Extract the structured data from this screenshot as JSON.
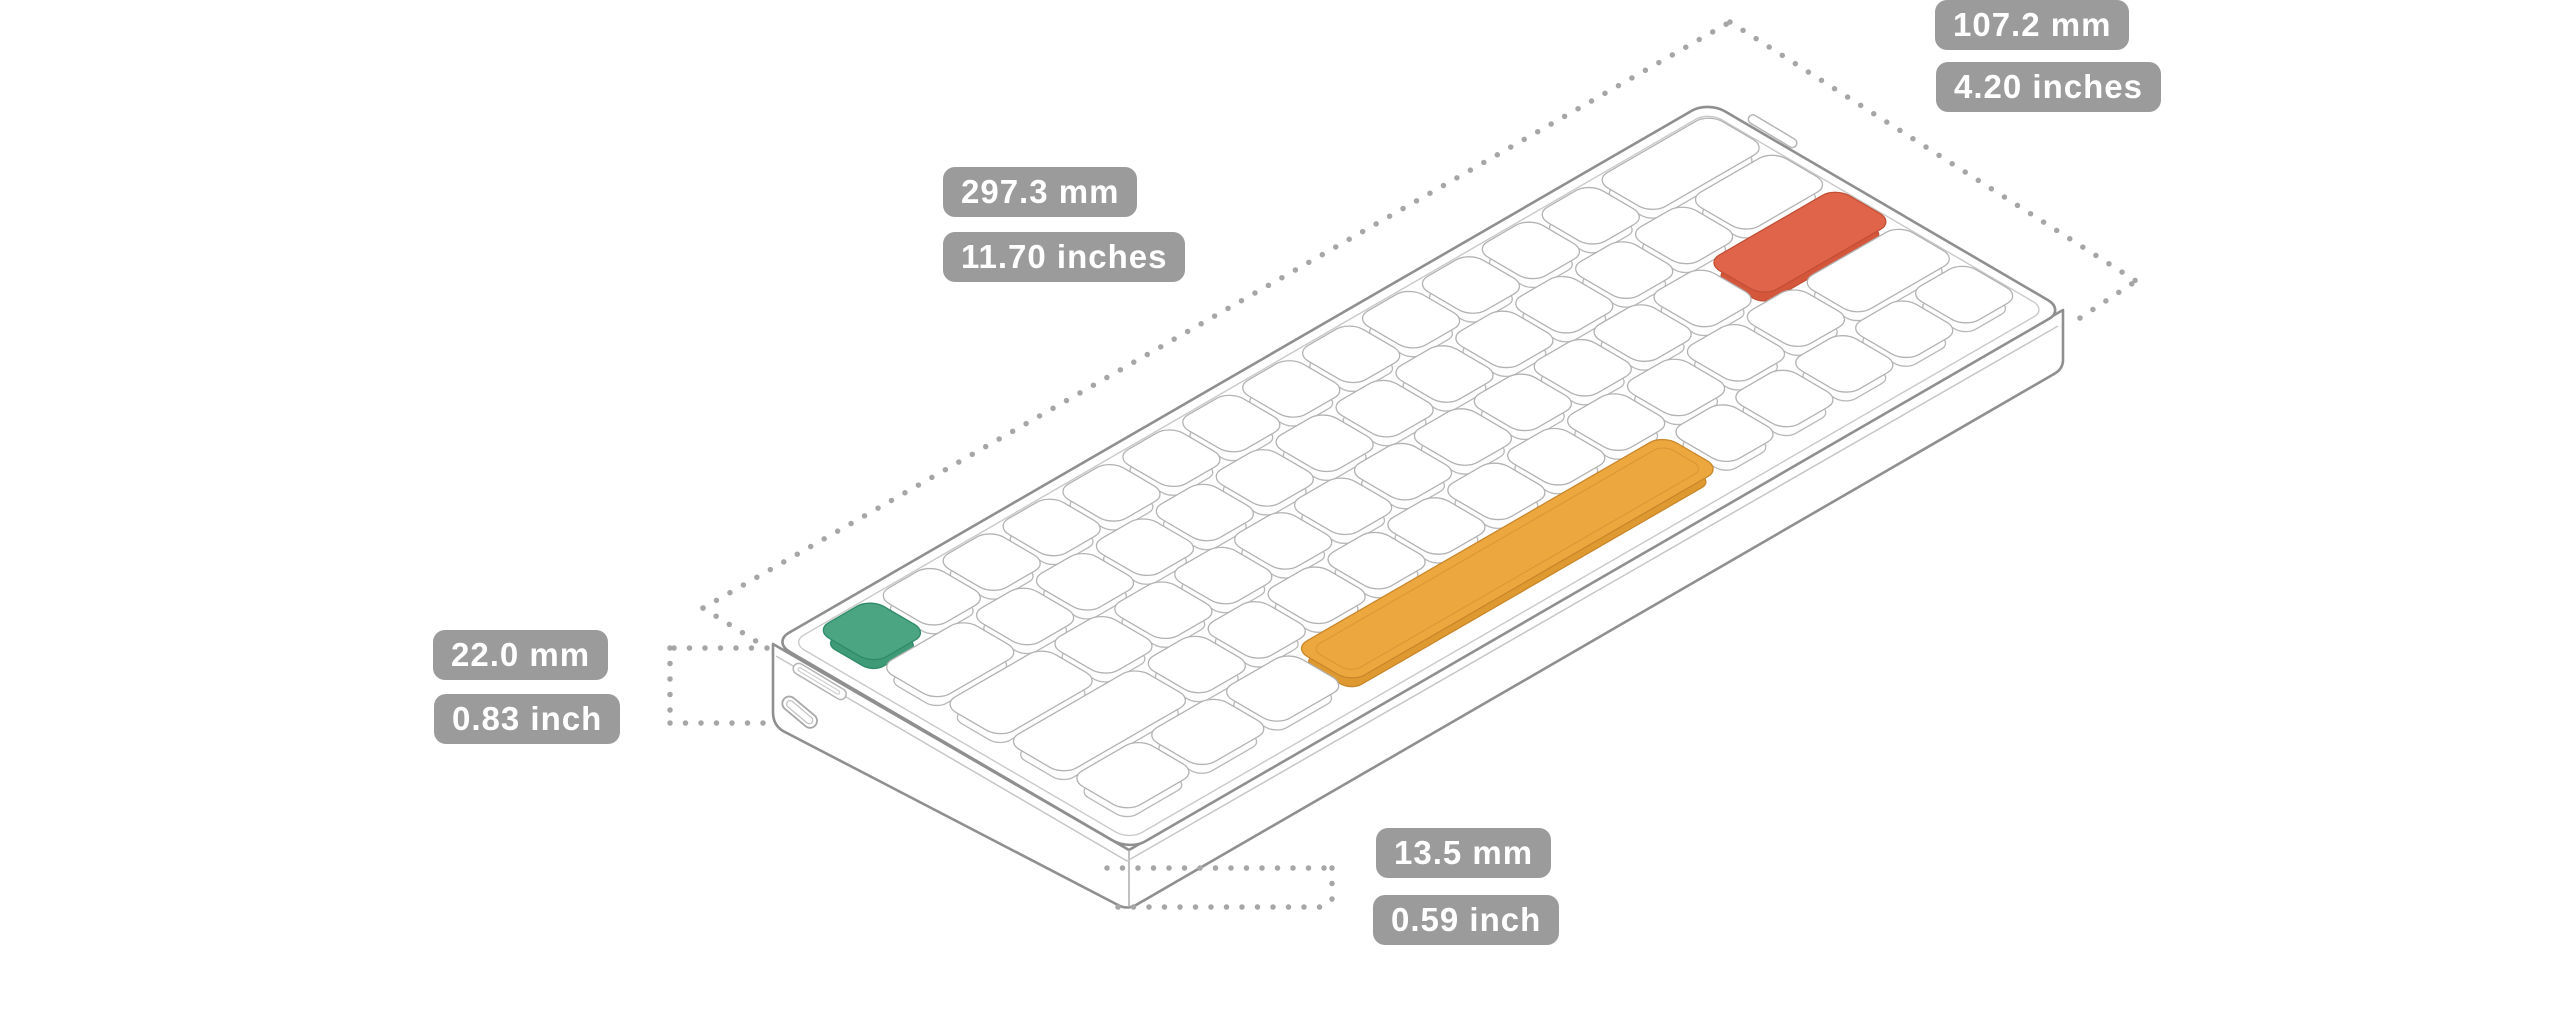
{
  "diagram": {
    "labels": {
      "depth_mm": "107.2 mm",
      "depth_in": "4.20 inches",
      "length_mm": "297.3 mm",
      "length_in": "11.70 inches",
      "rear_height_mm": "22.0 mm",
      "rear_height_in": "0.83 inch",
      "front_height_mm": "13.5 mm",
      "front_height_in": "0.59 inch"
    },
    "label_style": {
      "bg": "#9b9b9b",
      "text": "#ffffff"
    },
    "line_colors": {
      "case_outline": "#8f8f8f",
      "key_outline": "#b8b8b8",
      "dotted": "#a6a6a6"
    },
    "accent_colors": {
      "esc_key": "#4BA583",
      "enter_key": "#E0644A",
      "spacebar": "#ECA83F"
    },
    "accent_colors_base": {
      "esc_key": "#3F9A77",
      "enter_key": "#D4573C",
      "spacebar": "#DE9A30"
    },
    "accent_strokes": {
      "esc_key": "#2E8A68",
      "enter_key": "#C24F35",
      "spacebar": "#C9872B"
    },
    "keyboard": {
      "unit_mm": 19.05,
      "size_mm": {
        "length": 297.3,
        "depth": 107.2
      },
      "rows": [
        {
          "keys": [
            {
              "w": 1,
              "accent": "esc_key"
            },
            {
              "w": 1
            },
            {
              "w": 1
            },
            {
              "w": 1
            },
            {
              "w": 1
            },
            {
              "w": 1
            },
            {
              "w": 1
            },
            {
              "w": 1
            },
            {
              "w": 1
            },
            {
              "w": 1
            },
            {
              "w": 1
            },
            {
              "w": 1
            },
            {
              "w": 1
            },
            {
              "w": 2
            }
          ]
        },
        {
          "keys": [
            {
              "w": 1.5
            },
            {
              "w": 1
            },
            {
              "w": 1
            },
            {
              "w": 1
            },
            {
              "w": 1
            },
            {
              "w": 1
            },
            {
              "w": 1
            },
            {
              "w": 1
            },
            {
              "w": 1
            },
            {
              "w": 1
            },
            {
              "w": 1
            },
            {
              "w": 1
            },
            {
              "w": 1
            },
            {
              "w": 1.5
            }
          ]
        },
        {
          "keys": [
            {
              "w": 1.75
            },
            {
              "w": 1
            },
            {
              "w": 1
            },
            {
              "w": 1
            },
            {
              "w": 1
            },
            {
              "w": 1
            },
            {
              "w": 1
            },
            {
              "w": 1
            },
            {
              "w": 1
            },
            {
              "w": 1
            },
            {
              "w": 1
            },
            {
              "w": 1
            },
            {
              "w": 2.25,
              "accent": "enter_key"
            }
          ]
        },
        {
          "keys": [
            {
              "w": 2.25
            },
            {
              "w": 1
            },
            {
              "w": 1
            },
            {
              "w": 1
            },
            {
              "w": 1
            },
            {
              "w": 1
            },
            {
              "w": 1
            },
            {
              "w": 1
            },
            {
              "w": 1
            },
            {
              "w": 1
            },
            {
              "w": 1
            },
            {
              "w": 1
            },
            {
              "w": 1.75
            }
          ]
        },
        {
          "keys": [
            {
              "w": 1.25
            },
            {
              "w": 1.25
            },
            {
              "w": 1.25
            },
            {
              "w": 6.25,
              "accent": "spacebar"
            },
            {
              "w": 1
            },
            {
              "w": 1
            },
            {
              "w": 1
            },
            {
              "w": 1
            },
            {
              "w": 1
            }
          ]
        }
      ]
    }
  }
}
